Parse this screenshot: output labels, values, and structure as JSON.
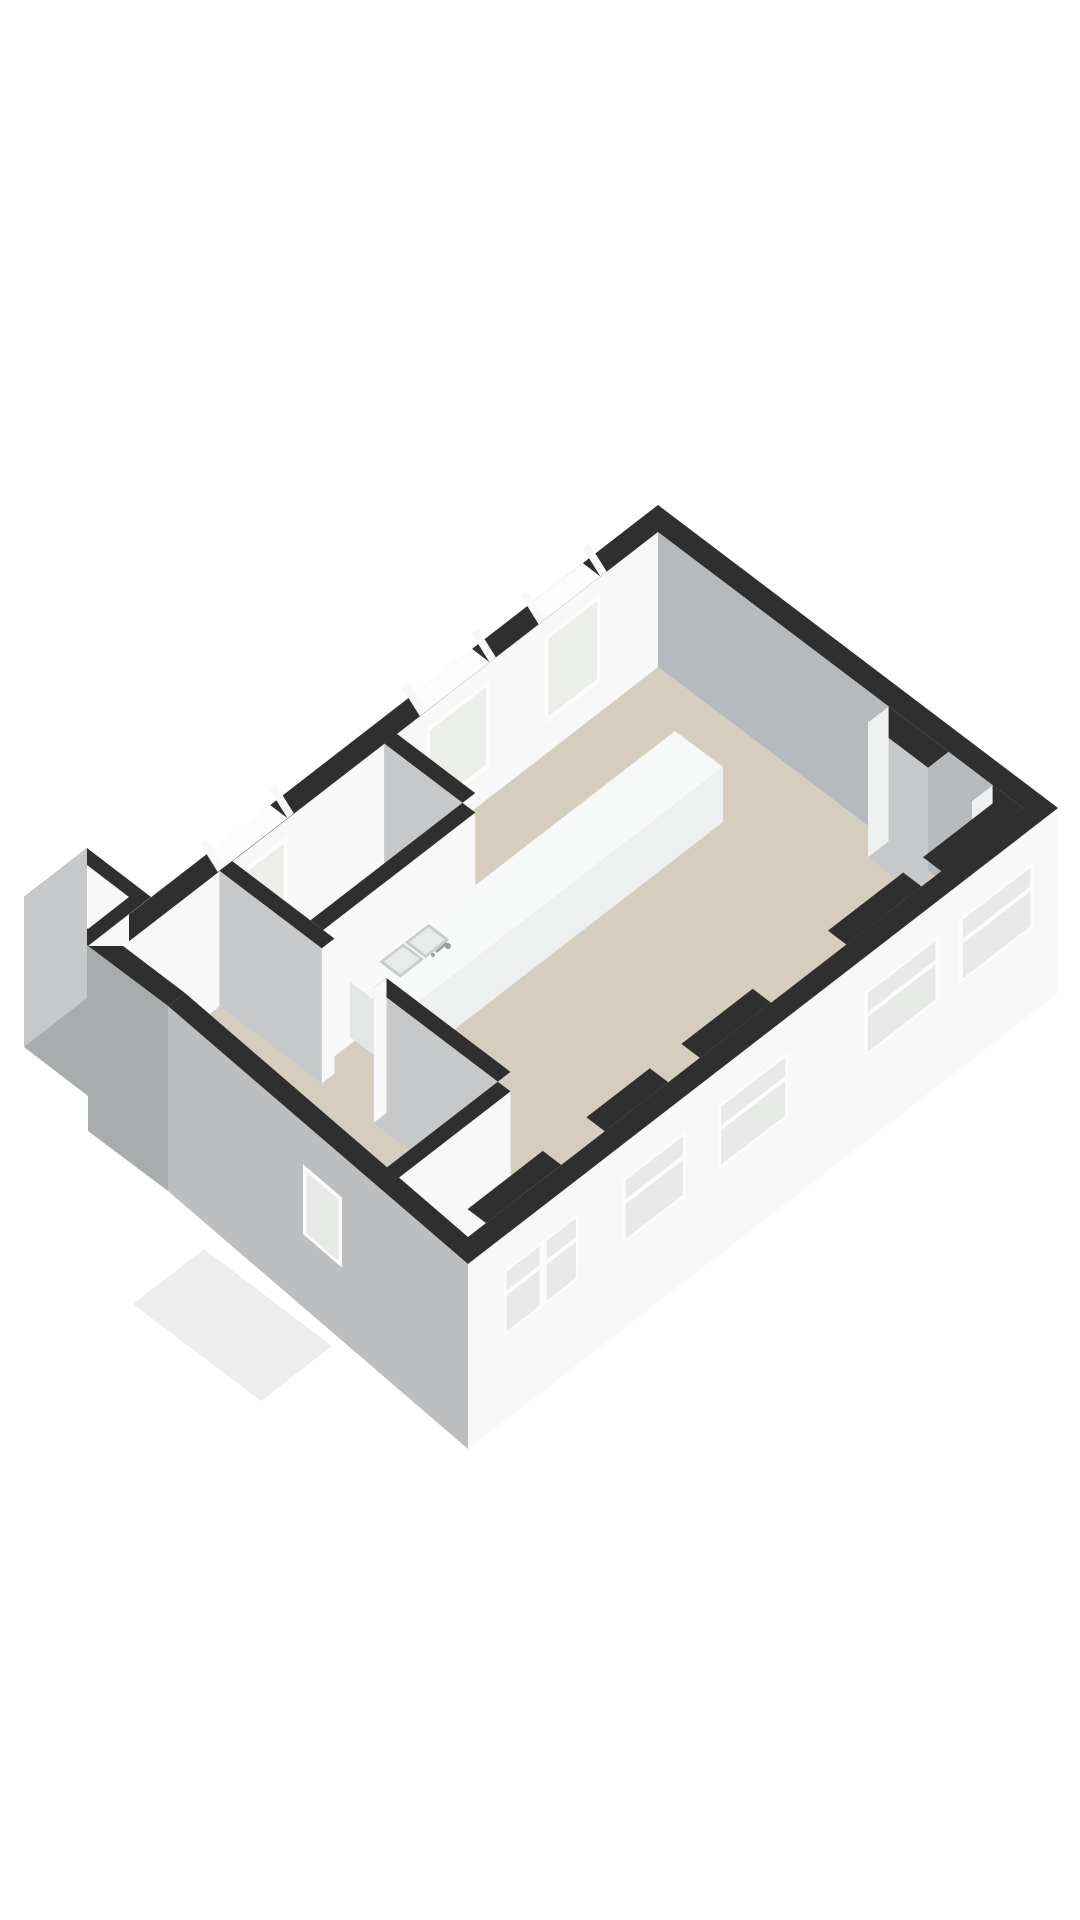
{
  "scene": {
    "kind": "isometric-3d-floor-plan",
    "background": "#ffffff",
    "colors": {
      "wall_cap": "#2f2f2f",
      "wall_white": "#f8f8f8",
      "wall_white_dim": "#eef0f0",
      "wall_gray": "#b7babc",
      "wall_gray_light": "#c6c8c9",
      "wall_gray_dark": "#a9acad",
      "wall_gray_mid": "#bcbebf",
      "floor": "#d5cec0",
      "floor_light": "#e9e6de",
      "sill": "#d8d2c6",
      "glass": "#eceee9",
      "glass_cool": "#e7e9e6",
      "frame_white": "#fcfcfc",
      "counter_top": "#f7f8f8",
      "counter_side": "#eef0f0",
      "counter_end": "#e4e6e6",
      "sink_rim": "#c9cccc",
      "sink_basin": "#e9ebeb",
      "metal": "#9aa0a1",
      "ghost": "#ededed",
      "box_floor": "#f1f1f0",
      "background": "#ffffff"
    },
    "objects": {
      "facade_windows_count": 5,
      "interior_wall_windows_count": 3,
      "angled_wall_windows_count": 1,
      "kitchen_island": {
        "present": true,
        "sinks": 2,
        "faucet": true
      },
      "wall_niches_count": 2,
      "small_shaft_room": {
        "present": true
      },
      "ghost_porch": {
        "present": true
      }
    }
  }
}
